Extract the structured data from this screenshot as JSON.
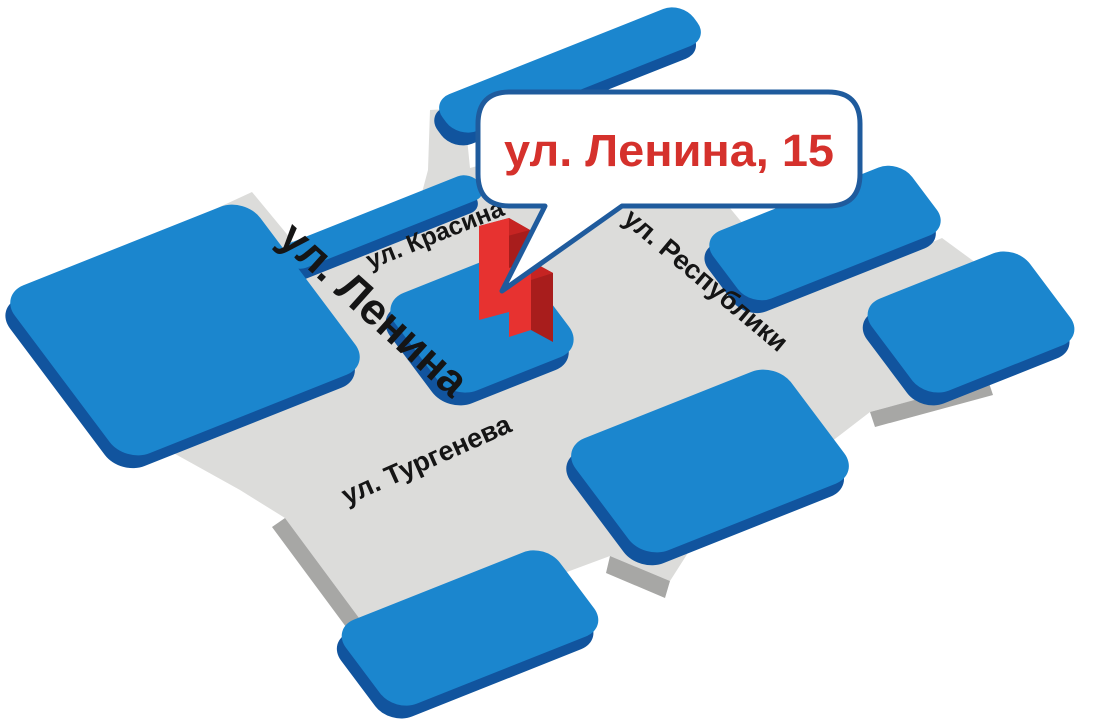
{
  "callout": {
    "address": "ул. Ленина, 15"
  },
  "streets": {
    "krasina": "ул. Красина",
    "lenina": "ул. Ленина",
    "respubliki": "ул. Республики",
    "turgeneva": "ул. Тургенева"
  },
  "colors": {
    "background": "#ffffff",
    "block_top": "#1b86ce",
    "block_side": "#11549e",
    "street_top": "#dcdcda",
    "street_side": "#a7a7a5",
    "label_ink": "#151515",
    "bubble_border": "#1f5b9d",
    "bubble_fill": "#ffffff",
    "address_red": "#d5312c",
    "building_front": "#e73230",
    "building_side": "#a81d1c",
    "building_top": "#c62422"
  }
}
